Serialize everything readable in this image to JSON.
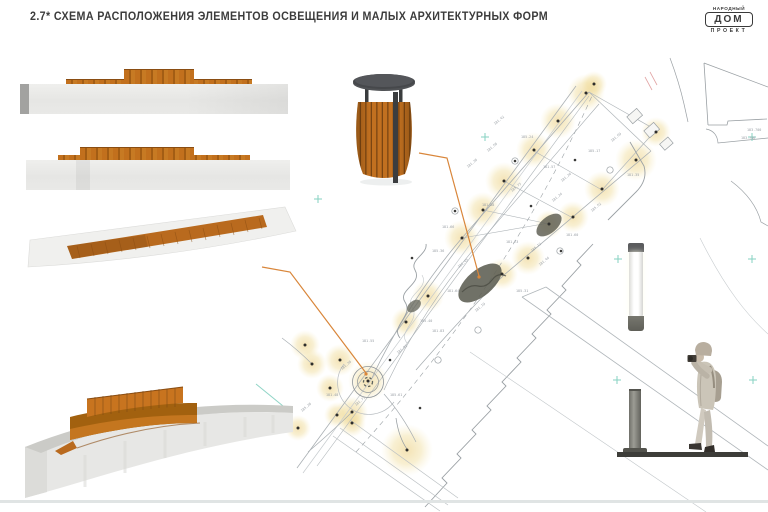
{
  "slide": {
    "title": "2.7* СХЕМА РАСПОЛОЖЕНИЯ ЭЛЕМЕНТОВ ОСВЕЩЕНИЯ И МАЛЫХ АРХИТЕКТУРНЫХ ФОРМ"
  },
  "logo": {
    "top": "НАРОДНЫЙ",
    "box": "ДОМ",
    "bottom": "ПРОЕКТ"
  },
  "colors": {
    "accent_leader": "#d9863a",
    "glow": "#e9c878",
    "survey_line": "#a6acb0",
    "grid_cross": "#86d2c2",
    "wood": "#c2701d",
    "wood_dark": "#8a4d12",
    "concrete": "#eaeae8",
    "metal": "#46484a"
  },
  "plan": {
    "glows": [
      [
        594,
        84,
        13
      ],
      [
        586,
        93,
        19
      ],
      [
        558,
        121,
        18
      ],
      [
        534,
        150,
        18
      ],
      [
        504,
        181,
        19
      ],
      [
        483,
        210,
        18
      ],
      [
        462,
        238,
        18
      ],
      [
        656,
        132,
        15
      ],
      [
        636,
        160,
        21
      ],
      [
        602,
        189,
        18
      ],
      [
        573,
        217,
        16
      ],
      [
        549,
        224,
        14
      ],
      [
        528,
        258,
        17
      ],
      [
        502,
        274,
        16
      ],
      [
        428,
        296,
        16
      ],
      [
        406,
        322,
        15
      ],
      [
        368,
        381,
        20
      ],
      [
        340,
        360,
        16
      ],
      [
        312,
        364,
        15
      ],
      [
        330,
        388,
        14
      ],
      [
        352,
        412,
        16
      ],
      [
        305,
        345,
        15
      ],
      [
        298,
        428,
        13
      ],
      [
        337,
        415,
        13
      ],
      [
        352,
        423,
        14
      ],
      [
        407,
        450,
        26
      ]
    ],
    "lamps": [
      [
        412,
        258
      ],
      [
        531,
        206
      ],
      [
        575,
        160
      ],
      [
        390,
        360
      ],
      [
        420,
        408
      ],
      [
        455,
        211
      ],
      [
        515,
        161
      ],
      [
        561,
        251
      ]
    ],
    "crosses": [
      [
        485,
        137
      ],
      [
        752,
        137
      ],
      [
        618,
        259
      ],
      [
        752,
        259
      ],
      [
        617,
        380
      ],
      [
        753,
        380
      ],
      [
        318,
        199
      ]
    ],
    "elevation_marks": [
      [
        495,
        125,
        "181.42",
        -40
      ],
      [
        521,
        138,
        "185.24",
        0
      ],
      [
        468,
        168,
        "181.38",
        -40
      ],
      [
        543,
        168,
        "181.57",
        0
      ],
      [
        512,
        192,
        "185.73",
        -40
      ],
      [
        482,
        206,
        "181.88",
        0
      ],
      [
        553,
        202,
        "181.24",
        -40
      ],
      [
        432,
        252,
        "185.36",
        0
      ],
      [
        459,
        268,
        "181.45",
        -40
      ],
      [
        506,
        243,
        "181.73",
        0
      ],
      [
        532,
        252,
        "185.12",
        -40
      ],
      [
        447,
        292,
        "181.64",
        0
      ],
      [
        476,
        312,
        "181.19",
        -40
      ],
      [
        420,
        322,
        "185.40",
        0
      ],
      [
        398,
        354,
        "181.92",
        -40
      ],
      [
        362,
        342,
        "181.55",
        0
      ],
      [
        342,
        370,
        "181.30",
        -40
      ],
      [
        390,
        396,
        "185.61",
        0
      ],
      [
        356,
        406,
        "181.77",
        -40
      ],
      [
        326,
        396,
        "181.48",
        0
      ],
      [
        302,
        412,
        "185.28",
        -40
      ],
      [
        432,
        332,
        "181.83",
        0
      ],
      [
        562,
        182,
        "181.26",
        -40
      ],
      [
        588,
        152,
        "185.17",
        0
      ],
      [
        612,
        142,
        "181.69",
        -40
      ],
      [
        627,
        176,
        "181.35",
        0
      ],
      [
        592,
        212,
        "185.52",
        -40
      ],
      [
        566,
        236,
        "181.60",
        0
      ],
      [
        540,
        266,
        "181.44",
        -40
      ],
      [
        516,
        292,
        "185.31",
        0
      ],
      [
        488,
        152,
        "181.58",
        -40
      ],
      [
        442,
        228,
        "181.66",
        0
      ],
      [
        747,
        131,
        "183.700",
        0
      ],
      [
        741,
        139,
        "183.706",
        0
      ]
    ]
  }
}
